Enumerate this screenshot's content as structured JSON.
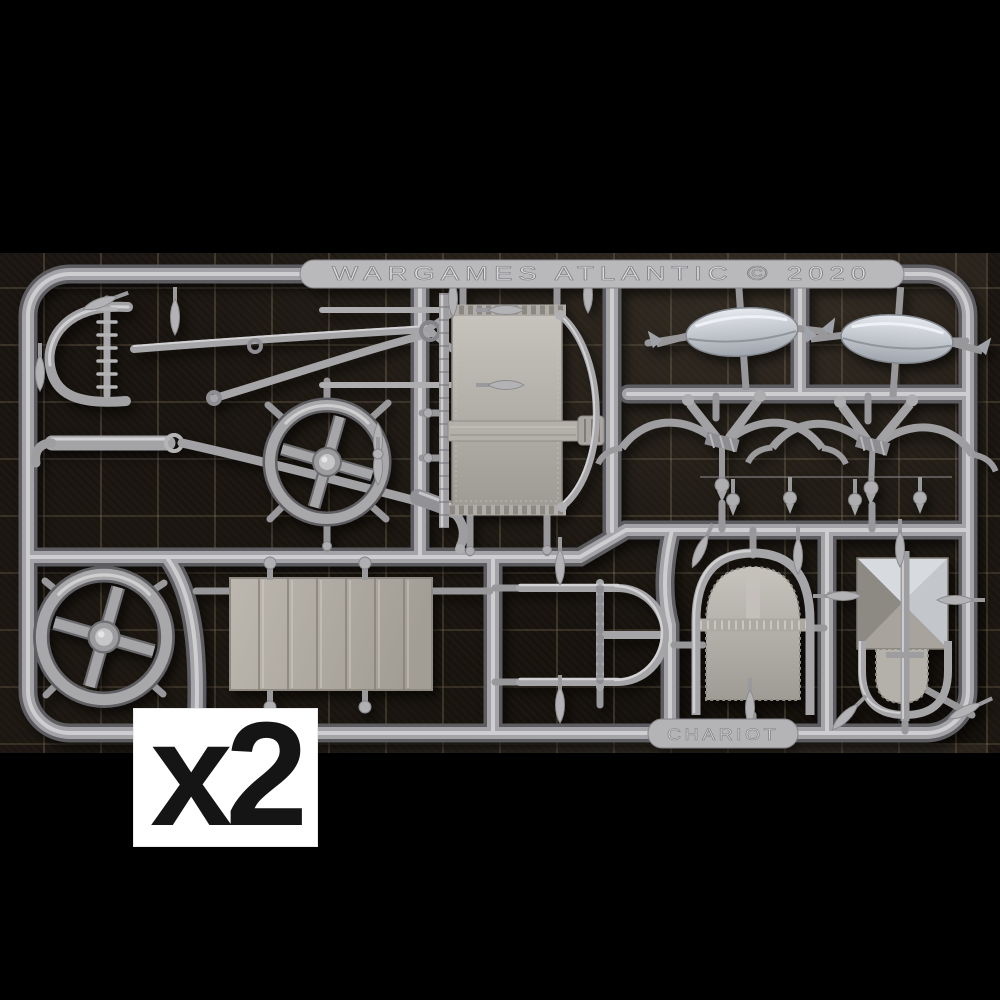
{
  "page": {
    "background_color": "#000000"
  },
  "photo": {
    "description": "Silver-grey plastic model sprue of an ancient war chariot kit photographed on a dark gridded cutting mat",
    "mat": {
      "base_color": "#17120e",
      "grid_color": "#a59678"
    },
    "sprue": {
      "plastic_color": "#a4a4a8",
      "highlight_color": "#d6d6d8",
      "shadow_color": "#5d5d61",
      "panel_color": "#b4b0aa",
      "bright_metal_color": "#dde1e6",
      "brand_plate_text": "WARGAMES ATLANTIC © 2020",
      "part_plate_text": "CHARIOT",
      "parts": [
        "draught-pole-and-harness",
        "four-spoke-wheel-upper",
        "four-spoke-wheel-lower",
        "chariot-side-panel",
        "wheel-hub-left",
        "wheel-hub-right",
        "horse-yoke-left",
        "horse-yoke-right",
        "plank-floor",
        "cab-rail-frame",
        "arched-cab-panel",
        "crossed-shield-panel",
        "javelin-tips"
      ]
    }
  },
  "overlay": {
    "quantity_label": "x2",
    "bg_color": "#ffffff",
    "text_color": "#151515"
  }
}
